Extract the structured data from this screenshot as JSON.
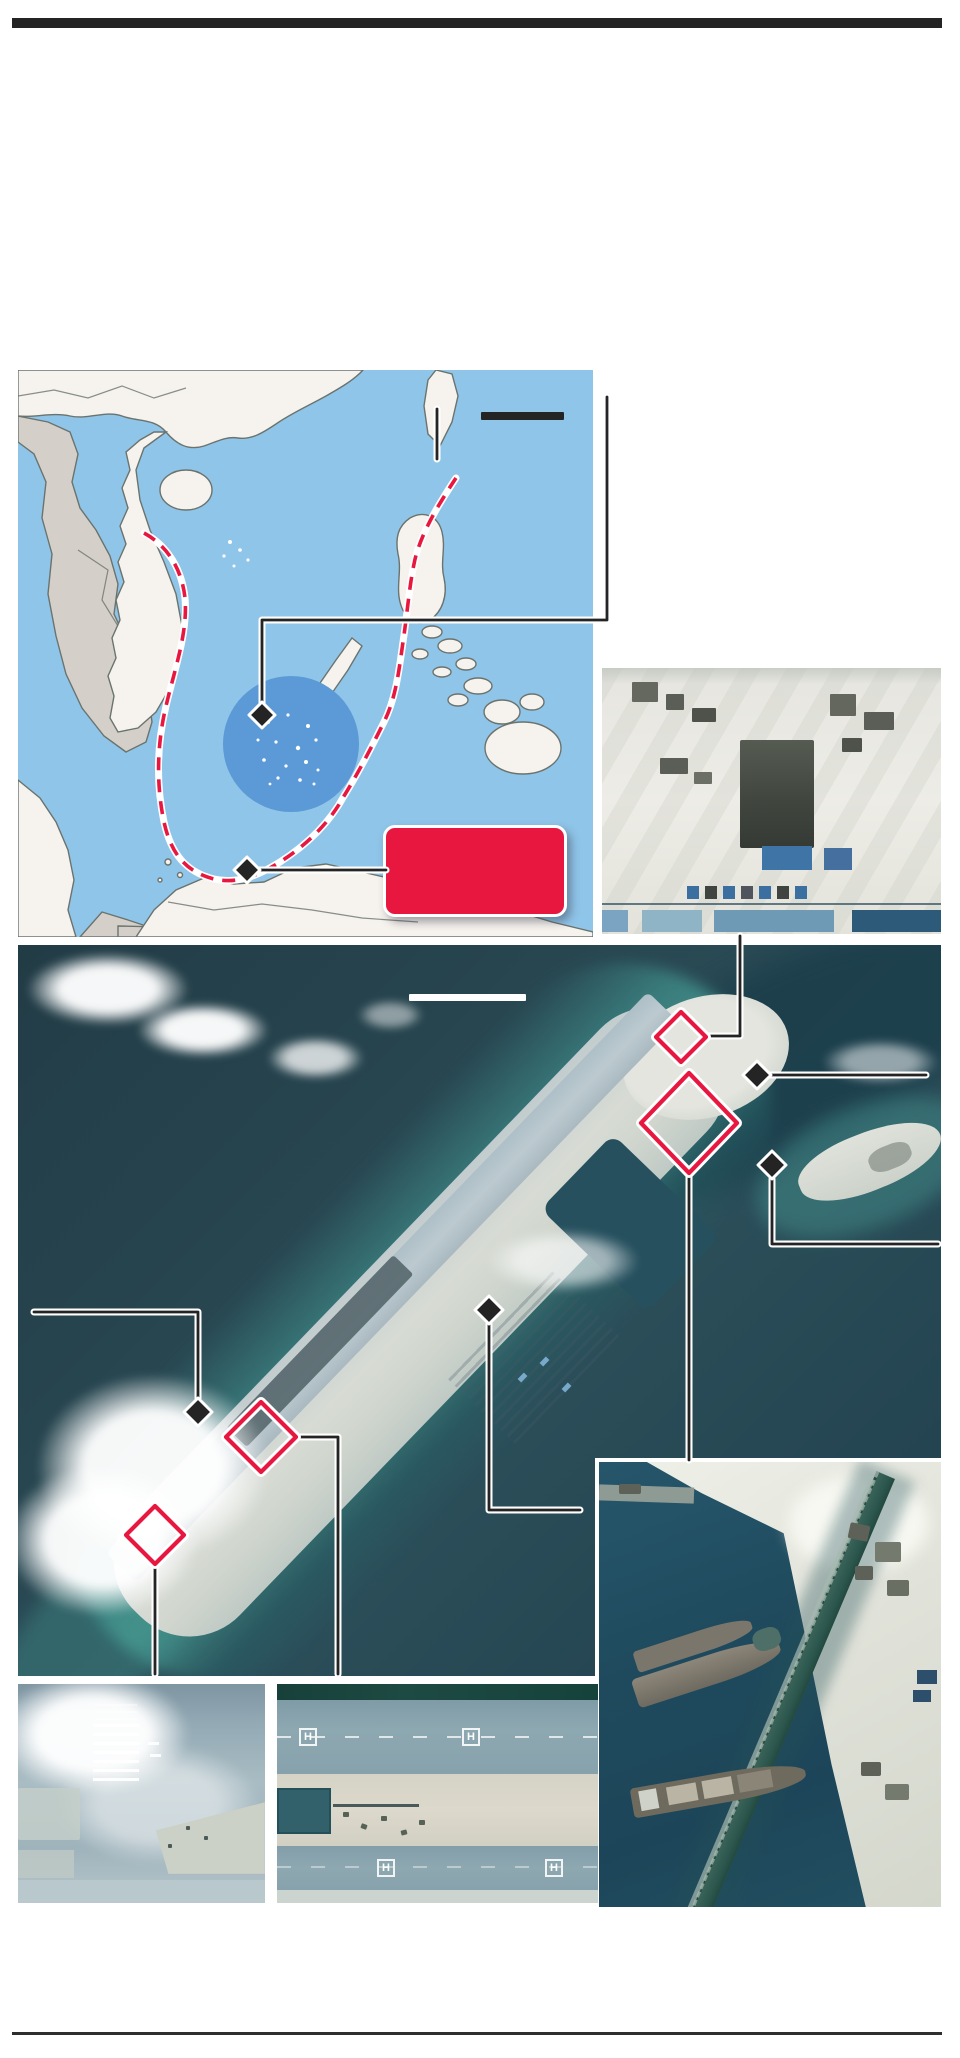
{
  "page": {
    "width": 960,
    "height": 2058,
    "background": "#ffffff"
  },
  "rules": {
    "top_rule_color": "#242424",
    "bottom_rule_color": "#2e2e2e"
  },
  "colors": {
    "ink": "#242424",
    "accent_red": "#e8173f",
    "casing": "#ffffff",
    "map_sea": "#8fc5e9",
    "map_land": "#f6f3ee",
    "map_land_alt": "#d4d0c9",
    "map_border": "#6b736e",
    "map_circle": "#5b9ad6",
    "ocean": "#27454f",
    "reef": "#3f8d89",
    "sand": "#d6dad3",
    "runway": "#b5c4cb",
    "harbor_water": "#1f4a5c",
    "pier": "#2d5b52",
    "shore_sand": "#e3e4db",
    "inset_pale": "#eae9e3",
    "inset_dark": "#45493f",
    "inset_blue": "#3f74a6",
    "haze_blue": "#9db3bd",
    "band_blue": "#8aa5af",
    "band_sand": "#d8d6c9",
    "strip_green": "#1c4a42",
    "building_teal": "#33616b"
  },
  "locator_map": {
    "sea_color": "#8fc5e9",
    "land_color": "#f6f3ee",
    "neighbor_land_color": "#d4d0c9",
    "border_color": "#6b736e",
    "claim_line": {
      "style": "dashed",
      "color": "#e8173f",
      "casing": "#ffffff"
    },
    "highlight_circle_color": "#5b9ad6",
    "island_speck_color": "#ffffff",
    "scalebar_color": "#242424",
    "label_box": {
      "fill": "#e8173f",
      "border": "#ffffff",
      "text": ""
    },
    "diamond_marker_color": "#242424",
    "diamond_marker_count": 2
  },
  "annotations": {
    "callout_line_color": "#242424",
    "callout_casing_color": "#ffffff",
    "black_diamond_count_on_island": 4,
    "red_diamond_outline_count_on_island": 4,
    "red_outline_color": "#e8173f",
    "island_scalebar_color": "#ffffff"
  },
  "satellite_panels": {
    "construction_site": {
      "base": "#eae9e3",
      "foundation": "#45493f",
      "roof_blue": "#3f74a6"
    },
    "island_overview": {
      "ocean": "#27454f",
      "reef": "#3f8d89",
      "sand": "#d6dad3",
      "runway": "#b5c4cb"
    },
    "harbor": {
      "water": "#1f4a5c",
      "pier": "#2d5b52",
      "sand": "#e3e4db"
    },
    "runway_threshold": {
      "haze": "#9db3bd",
      "marking_color": "#ffffff"
    },
    "helipad_strip": {
      "marking_text": "H",
      "marking_count": 4,
      "marking_color": "#ffffff",
      "band_color": "#8aa5af",
      "sand_color": "#d8d6c9",
      "green_strip": "#1c4a42"
    }
  }
}
